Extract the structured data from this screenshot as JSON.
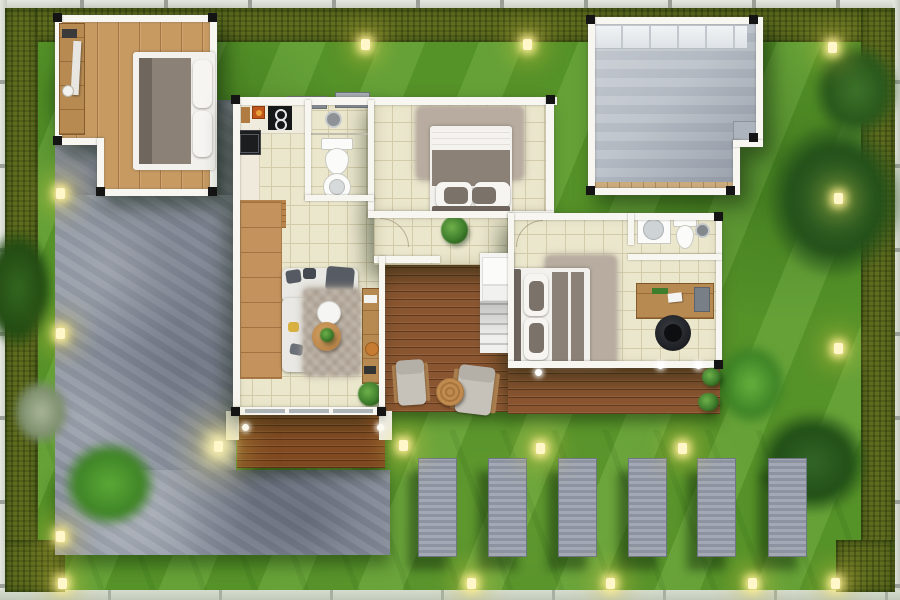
{
  "scene": {
    "kind": "architectural-floor-plan-rendering",
    "view": "top-down",
    "description": "Single-storey house plan set in a fenced garden with hedges, lawn, concrete driveway, wooden decks and stepping pads"
  },
  "palette": {
    "grass": "#5d9c2c",
    "hedge": "#5f6d20",
    "concrete": "#8f96a2",
    "pad": "#9aa0ad",
    "patio": "#bcc2ca",
    "tile": "#ebe7cd",
    "tile-line": "#d3cbaa",
    "wall": "#f7f6f1",
    "post": "#141414",
    "wood": "#c79a62",
    "deck": "#8a5631",
    "desk-wood": "#b78a52",
    "fabric": "#8b8177",
    "rug": "#b7ac9f",
    "light-glow": "#fff6c9"
  },
  "site": {
    "boundary": [
      "white picket fence strip on all four sides",
      "olive hedge along left, top and right edges and bottom corners"
    ],
    "lawn": "striped mown grass",
    "driveway": "large mottled grey concrete apron on the left, widening at the bottom",
    "stepping_pads": {
      "count": 6,
      "shape": "vertical grey concrete rectangles in a row on the lower lawn"
    },
    "garden_lights": {
      "count": 14,
      "style": "small glowing yellow ground lights"
    },
    "planting": [
      "dark tree canopies top-right and bottom-right",
      "bright shrub clumps",
      "pale grey-green plant on left lawn"
    ]
  },
  "buildings": {
    "detached_bedroom": {
      "location": "top-left",
      "floor": "light oak plank",
      "furniture": [
        "double bed with grey duvet and white pillows",
        "long wooden desk along west wall",
        "cup",
        "leaning board"
      ]
    },
    "covered_patio": {
      "location": "top-right",
      "floor": "light grey concrete",
      "features": [
        "glass roof band along north edge",
        "timber threshold along south edge",
        "notched south-east corner with step"
      ]
    },
    "main_house": {
      "rooms": [
        {
          "name": "kitchen",
          "items": [
            "L-shaped counter",
            "black cooktop with two burners",
            "black sink",
            "chopping board",
            "red canisters",
            "timber mat"
          ]
        },
        {
          "name": "bathroom-1",
          "items": [
            "shower head",
            "toilet",
            "round washbasin"
          ]
        },
        {
          "name": "bedroom-2",
          "items": [
            "double bed facing north",
            "shaggy rug",
            "potted plant at door"
          ]
        },
        {
          "name": "living-room",
          "items": [
            "timber feature sideboard",
            "L-shaped white sofa with grey cushions",
            "patterned rug",
            "round timber coffee table",
            "round white side table",
            "TV console",
            "floor plant",
            "sliding glass door to deck"
          ]
        },
        {
          "name": "hallway",
          "items": [
            "door arc",
            "staircase with white treads"
          ]
        },
        {
          "name": "master-bedroom",
          "items": [
            "double bed with grey striped duvet",
            "shaggy rug",
            "timber desk with laptop and papers",
            "black office chair"
          ]
        },
        {
          "name": "master-bathroom",
          "items": [
            "vanity with round basin",
            "toilet",
            "shower head"
          ]
        }
      ],
      "exterior": [
        "two AC units on the north wall",
        "entry deck with white pillars and lights",
        "large rear timber deck with two armchairs, round side table and potted plants"
      ]
    }
  }
}
